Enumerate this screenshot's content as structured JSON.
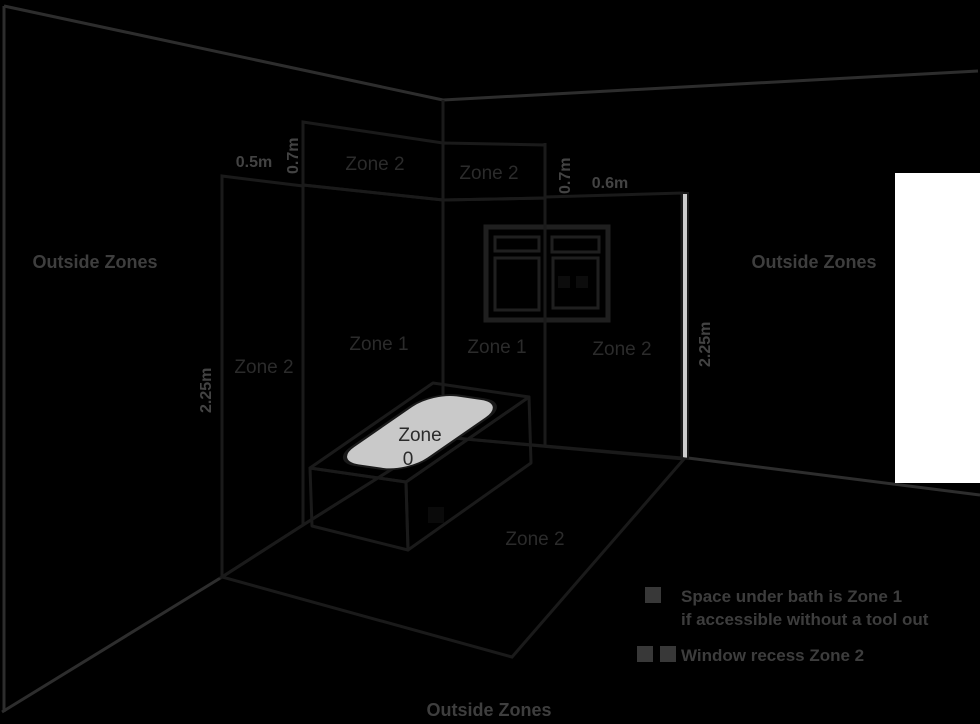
{
  "diagram": {
    "outside_zones_left": "Outside Zones",
    "outside_zones_right": "Outside Zones",
    "outside_zones_bottom": "Outside Zones",
    "dims": {
      "top_left_width": "0.5m",
      "top_left_height": "0.7m",
      "top_right_height": "0.7m",
      "top_right_width": "0.6m",
      "left_wall_height": "2.25m",
      "right_wall_height": "2.25m"
    },
    "zones": {
      "top_band_left": "Zone 2",
      "top_band_right": "Zone 2",
      "left_wall": "Zone 2",
      "back_wall_left": "Zone 1",
      "back_wall_right": "Zone 1",
      "right_wall": "Zone 2",
      "bath_line1": "Zone",
      "bath_line2": "0",
      "floor": "Zone 2"
    },
    "legend": {
      "item1_line1": "Space under bath is Zone 1",
      "item1_line2": "if accessible without a tool out",
      "item2": "Window recess Zone 2"
    },
    "colors": {
      "background": "#000000",
      "wall_light": "#b5b5b5",
      "wall_mid": "#9a9a9a",
      "top_band_gray": "#8d8d8d",
      "left_band_gray": "#8f8f8f",
      "floor_gray": "#929292",
      "tub_gray": "#c9c9c9",
      "bath_white": "#ffffff",
      "wall_edge_light": "#cdcdcd",
      "outline": "#1a1a1a",
      "dim_text": "#434343",
      "zone_text": "#2b2b2b"
    }
  }
}
